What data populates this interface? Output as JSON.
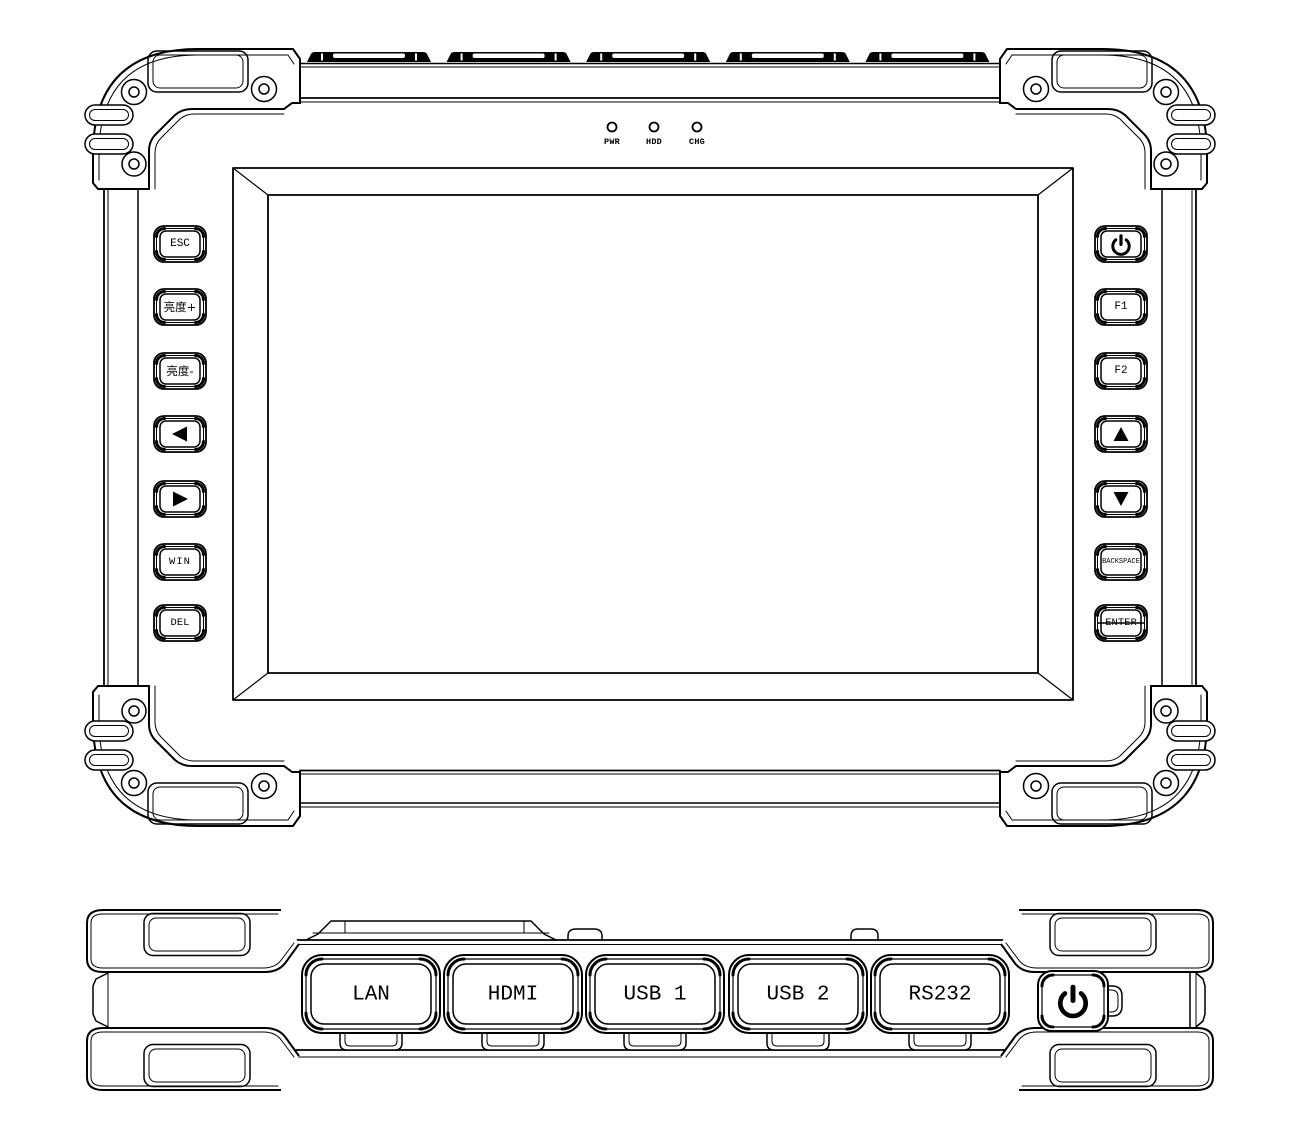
{
  "colors": {
    "line": "#000000",
    "background": "#ffffff"
  },
  "front_view": {
    "status_leds": [
      {
        "id": "pwr",
        "label": "PWR"
      },
      {
        "id": "hdd",
        "label": "HDD"
      },
      {
        "id": "chg",
        "label": "CHG"
      }
    ],
    "left_keys": [
      {
        "id": "esc",
        "label": "ESC"
      },
      {
        "id": "brightness-up",
        "label": "亮度+"
      },
      {
        "id": "brightness-down",
        "label": "亮度-"
      },
      {
        "id": "arrow-left",
        "icon": "left-triangle-icon"
      },
      {
        "id": "arrow-right",
        "icon": "right-triangle-icon"
      },
      {
        "id": "win",
        "label": "WIN"
      },
      {
        "id": "del",
        "label": "DEL"
      }
    ],
    "right_keys": [
      {
        "id": "power",
        "icon": "power-symbol-icon"
      },
      {
        "id": "f1",
        "label": "F1"
      },
      {
        "id": "f2",
        "label": "F2"
      },
      {
        "id": "arrow-up",
        "icon": "up-triangle-icon"
      },
      {
        "id": "arrow-down",
        "icon": "down-triangle-icon"
      },
      {
        "id": "backspace",
        "label": "BACKSPACE"
      },
      {
        "id": "enter",
        "label": "ENTER"
      }
    ]
  },
  "bottom_view": {
    "port_covers": [
      {
        "id": "lan",
        "label": "LAN"
      },
      {
        "id": "hdmi",
        "label": "HDMI"
      },
      {
        "id": "usb1",
        "label": "USB 1"
      },
      {
        "id": "usb2",
        "label": "USB 2"
      },
      {
        "id": "rs232",
        "label": "RS232"
      }
    ],
    "power_button": {
      "icon": "power-symbol-icon"
    }
  }
}
